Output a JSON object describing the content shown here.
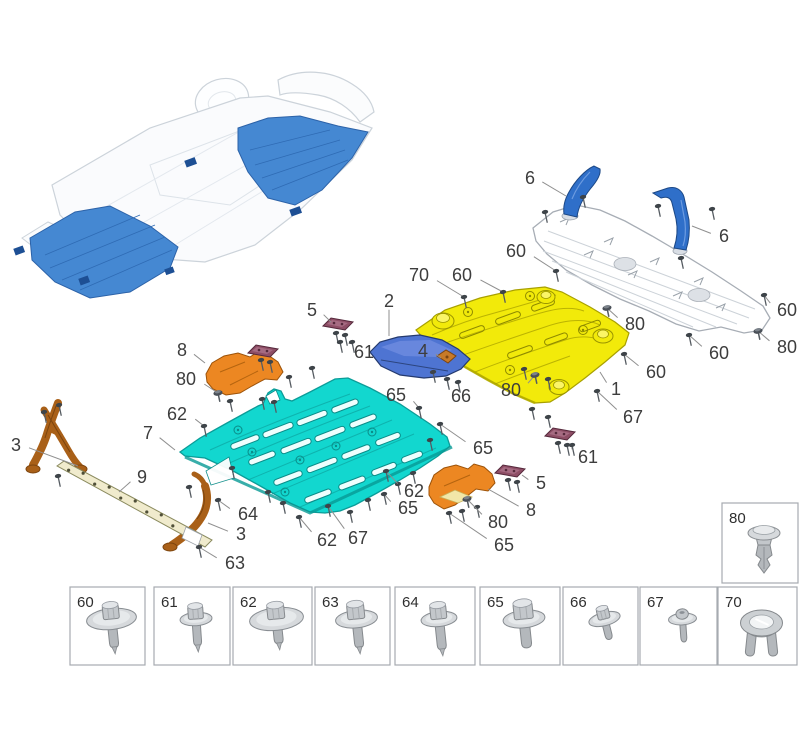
{
  "diagram": {
    "title": "underbody-protection-panels-exploded-view",
    "background": "#ffffff",
    "label_color": "#3d3d3d",
    "leader_color": "#8f8f8f",
    "label_font_size": 18,
    "box_label_font_size": 15
  },
  "colors": {
    "cyan_panel": "#12d7cf",
    "cyan_edge": "#0b9c98",
    "yellow_panel": "#f2ea0a",
    "yellow_edge": "#a8a000",
    "white_panel_edge": "#a7adb5",
    "blue_bracket": "#2f6fc9",
    "blue_deflector": "#4e74d2",
    "orange_bracket": "#ec8722",
    "brown_bracket": "#a96018",
    "purple_clip": "#8e4e66",
    "sill_strip": "#f0ebcd",
    "overview_highlight": "#4588d2",
    "overview_outline": "#ccd3da",
    "fastener_gray": "#c6cacd",
    "box_border": "#a6abb0"
  },
  "callouts": [
    {
      "label": "6",
      "x": 530,
      "y": 178,
      "tx": 566,
      "ty": 196,
      "glyph": null
    },
    {
      "label": "6",
      "x": 724,
      "y": 236,
      "tx": 692,
      "ty": 226,
      "glyph": null
    },
    {
      "label": "60",
      "x": 516,
      "y": 251,
      "tx": 556,
      "ty": 271,
      "glyph": "screw"
    },
    {
      "label": "70",
      "x": 419,
      "y": 275,
      "tx": 464,
      "ty": 297,
      "glyph": "screw"
    },
    {
      "label": "60",
      "x": 462,
      "y": 275,
      "tx": 503,
      "ty": 292,
      "glyph": "screw"
    },
    {
      "label": "60",
      "x": 787,
      "y": 310,
      "tx": 764,
      "ty": 295,
      "glyph": "screw"
    },
    {
      "label": "80",
      "x": 787,
      "y": 347,
      "tx": 758,
      "ty": 331,
      "glyph": "rivet"
    },
    {
      "label": "60",
      "x": 719,
      "y": 353,
      "tx": 689,
      "ty": 335,
      "glyph": "screw"
    },
    {
      "label": "60",
      "x": 656,
      "y": 372,
      "tx": 624,
      "ty": 354,
      "glyph": "screw"
    },
    {
      "label": "80",
      "x": 635,
      "y": 324,
      "tx": 607,
      "ty": 308,
      "glyph": "rivet"
    },
    {
      "label": "1",
      "x": 616,
      "y": 389,
      "tx": 600,
      "ty": 372,
      "glyph": null
    },
    {
      "label": "67",
      "x": 633,
      "y": 417,
      "tx": 597,
      "ty": 391,
      "glyph": "screw"
    },
    {
      "label": "2",
      "x": 389,
      "y": 301,
      "tx": 389,
      "ty": 336,
      "glyph": null
    },
    {
      "label": "5",
      "x": 312,
      "y": 310,
      "tx": 331,
      "ty": 322,
      "glyph": null
    },
    {
      "label": "61",
      "x": 364,
      "y": 352,
      "tx": 352,
      "ty": 342,
      "glyph": "screw"
    },
    {
      "label": "4",
      "x": 423,
      "y": 351,
      "tx": 441,
      "ty": 358,
      "glyph": null
    },
    {
      "label": "66",
      "x": 461,
      "y": 396,
      "tx": 447,
      "ty": 379,
      "glyph": "screw"
    },
    {
      "label": "65",
      "x": 396,
      "y": 395,
      "tx": 419,
      "ty": 408,
      "glyph": "screw"
    },
    {
      "label": "80",
      "x": 511,
      "y": 390,
      "tx": 535,
      "ty": 375,
      "glyph": "rivet"
    },
    {
      "label": "8",
      "x": 182,
      "y": 350,
      "tx": 205,
      "ty": 363,
      "glyph": null
    },
    {
      "label": "80",
      "x": 186,
      "y": 379,
      "tx": 218,
      "ty": 393,
      "glyph": "rivet"
    },
    {
      "label": "62",
      "x": 177,
      "y": 414,
      "tx": 204,
      "ty": 426,
      "glyph": "screw"
    },
    {
      "label": "7",
      "x": 148,
      "y": 433,
      "tx": 175,
      "ty": 450,
      "glyph": null
    },
    {
      "label": "3",
      "x": 16,
      "y": 445,
      "tx": 78,
      "ty": 466,
      "glyph": null
    },
    {
      "label": "9",
      "x": 142,
      "y": 477,
      "tx": 119,
      "ty": 492,
      "glyph": null
    },
    {
      "label": "64",
      "x": 248,
      "y": 514,
      "tx": 218,
      "ty": 500,
      "glyph": "screw"
    },
    {
      "label": "3",
      "x": 241,
      "y": 534,
      "tx": 208,
      "ty": 523,
      "glyph": null
    },
    {
      "label": "63",
      "x": 235,
      "y": 563,
      "tx": 199,
      "ty": 547,
      "glyph": "screw"
    },
    {
      "label": "62",
      "x": 327,
      "y": 540,
      "tx": 299,
      "ty": 517,
      "glyph": "screw"
    },
    {
      "label": "67",
      "x": 358,
      "y": 538,
      "tx": 328,
      "ty": 506,
      "glyph": "screw"
    },
    {
      "label": "62",
      "x": 414,
      "y": 491,
      "tx": 386,
      "ty": 471,
      "glyph": "screw"
    },
    {
      "label": "65",
      "x": 408,
      "y": 508,
      "tx": 384,
      "ty": 494,
      "glyph": "screw"
    },
    {
      "label": "65",
      "x": 483,
      "y": 448,
      "tx": 440,
      "ty": 424,
      "glyph": "screw"
    },
    {
      "label": "61",
      "x": 588,
      "y": 457,
      "tx": 572,
      "ty": 445,
      "glyph": "screw"
    },
    {
      "label": "5",
      "x": 541,
      "y": 483,
      "tx": 522,
      "ty": 475,
      "glyph": null
    },
    {
      "label": "8",
      "x": 531,
      "y": 510,
      "tx": 488,
      "ty": 489,
      "glyph": null
    },
    {
      "label": "80",
      "x": 498,
      "y": 522,
      "tx": 467,
      "ty": 499,
      "glyph": "rivet"
    },
    {
      "label": "65",
      "x": 504,
      "y": 545,
      "tx": 449,
      "ty": 513,
      "glyph": "screw"
    }
  ],
  "extra_screws": [
    [
      545,
      212
    ],
    [
      583,
      197
    ],
    [
      658,
      206
    ],
    [
      712,
      209
    ],
    [
      681,
      258
    ],
    [
      433,
      372
    ],
    [
      458,
      382
    ],
    [
      524,
      369
    ],
    [
      548,
      379
    ],
    [
      289,
      377
    ],
    [
      312,
      368
    ],
    [
      232,
      468
    ],
    [
      268,
      492
    ],
    [
      283,
      503
    ],
    [
      350,
      512
    ],
    [
      368,
      500
    ],
    [
      398,
      484
    ],
    [
      413,
      473
    ],
    [
      430,
      440
    ],
    [
      59,
      405
    ],
    [
      44,
      412
    ],
    [
      58,
      476
    ],
    [
      189,
      487
    ],
    [
      230,
      401
    ],
    [
      262,
      399
    ],
    [
      274,
      402
    ],
    [
      462,
      511
    ],
    [
      477,
      507
    ],
    [
      340,
      342
    ],
    [
      532,
      409
    ],
    [
      548,
      417
    ]
  ],
  "fastener_boxes": [
    {
      "label": "60",
      "icon": "bolt-large-washer",
      "x": 70,
      "y": 587,
      "w": 75,
      "h": 78
    },
    {
      "label": "61",
      "icon": "bolt-small-washer",
      "x": 154,
      "y": 587,
      "w": 76,
      "h": 78
    },
    {
      "label": "62",
      "icon": "bolt-stepped-washer",
      "x": 233,
      "y": 587,
      "w": 79,
      "h": 78
    },
    {
      "label": "63",
      "icon": "hex-flange-bolt",
      "x": 315,
      "y": 587,
      "w": 75,
      "h": 78
    },
    {
      "label": "64",
      "icon": "hex-bolt-long",
      "x": 395,
      "y": 587,
      "w": 80,
      "h": 78
    },
    {
      "label": "65",
      "icon": "hex-flange-bolt-large",
      "x": 480,
      "y": 587,
      "w": 80,
      "h": 78
    },
    {
      "label": "66",
      "icon": "screw-washer-small",
      "x": 563,
      "y": 587,
      "w": 75,
      "h": 78
    },
    {
      "label": "67",
      "icon": "screw-dome-small",
      "x": 640,
      "y": 587,
      "w": 77,
      "h": 78
    },
    {
      "label": "70",
      "icon": "expansion-grommet",
      "x": 718,
      "y": 587,
      "w": 79,
      "h": 78
    }
  ],
  "clip_box": {
    "label": "80",
    "icon": "push-pin-rivet",
    "x": 722,
    "y": 503,
    "w": 76,
    "h": 80
  }
}
